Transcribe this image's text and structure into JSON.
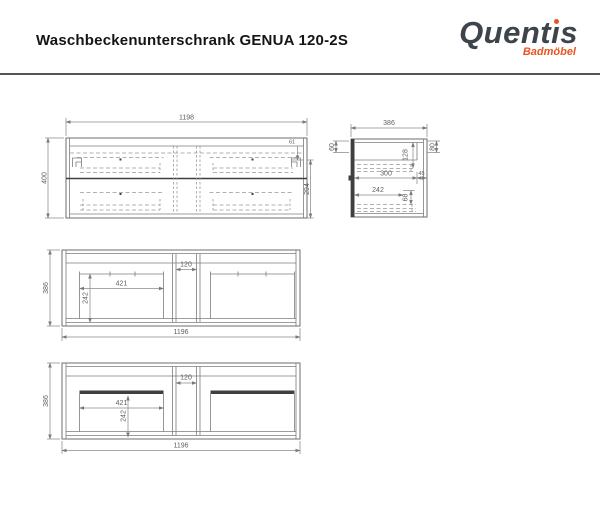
{
  "header": {
    "title": "Waschbeckenunterschrank GENUA 120-2S",
    "logo": {
      "brand_part1": "Quent",
      "brand_i": "ı",
      "brand_part2": "s",
      "subtitle": "Badmöbel"
    }
  },
  "colors": {
    "accent_orange": "#E8551E",
    "logo_gray": "#3E444B",
    "drawing_line_gray": "#6E6E6E",
    "dimension_text_gray": "#5E5E5E"
  },
  "views": {
    "front": {
      "width": "1198",
      "height": "400",
      "top_right_offset": "61",
      "lower_height": "294"
    },
    "side": {
      "depth": "386",
      "top_left_height": "60",
      "top_right_height": "80",
      "drawer_inner_height": "128",
      "inner_depth": "300",
      "back_gap": "45",
      "lower_inner_depth": "242",
      "lower_inner_height": "68"
    },
    "top_mid": {
      "depth": "386",
      "center_gap": "120",
      "cutout_width": "421",
      "cutout_depth": "242",
      "width": "1196"
    },
    "top_bottom": {
      "depth": "386",
      "center_gap": "120",
      "cutout_width": "421",
      "cutout_depth": "242",
      "width": "1196"
    }
  }
}
